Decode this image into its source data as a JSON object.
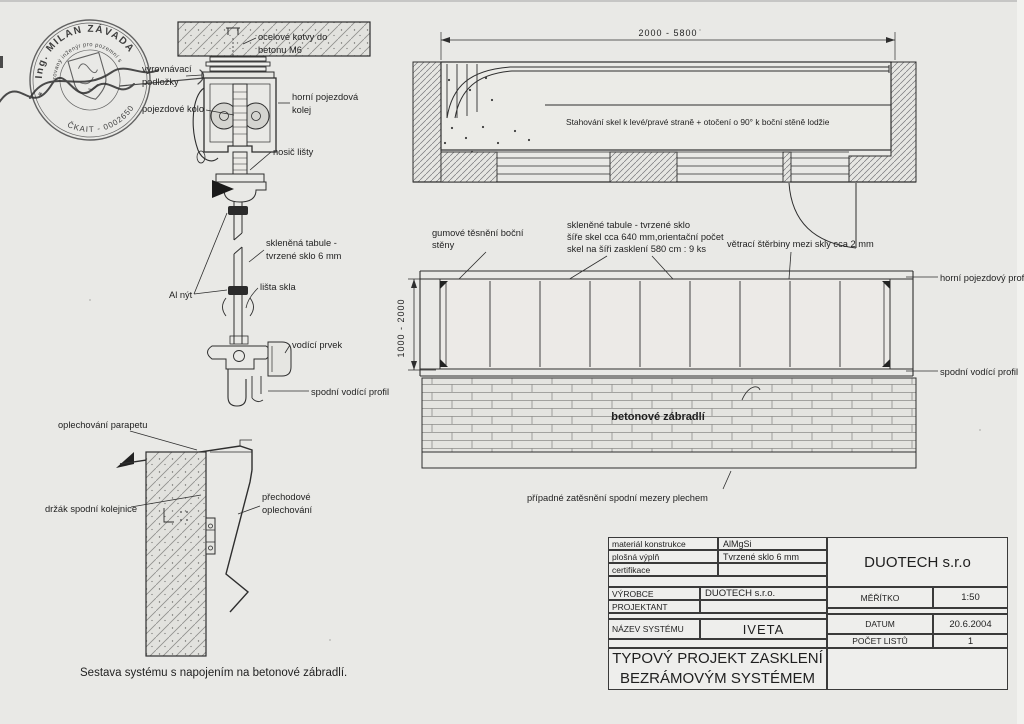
{
  "left_section": {
    "caption": "Sestava systému s napojením na betonové zábradlí.",
    "labels": {
      "anchor_l1": "ocelové kotvy do",
      "anchor_l2": "betonu M6",
      "shims_l1": "vyrovnávací",
      "shims_l2": "podložky",
      "wheel": "pojezdové kolo",
      "top_rail_l1": "horní pojezdová",
      "top_rail_l2": "kolej",
      "carrier": "nosič lišty",
      "glass_l1": "skleněná tabule -",
      "glass_l2": "tvrzené sklo 6 mm",
      "rivet": "Al nýt",
      "glass_strip": "lišta skla",
      "guide_element": "vodící prvek",
      "bottom_guide": "spodní vodící profil",
      "parapet_flashing": "oplechování parapetu",
      "rail_bracket": "držák spodní kolejnice",
      "transition_l1": "přechodové",
      "transition_l2": "oplechování"
    }
  },
  "plan_view": {
    "dimension": "2000 - 5800",
    "note": "Stahování skel k levé/pravé straně + otočení o 90° k boční stěně lodžie"
  },
  "elevation": {
    "dimension": "1000 - 2000",
    "panel_count": 9,
    "labels": {
      "gasket_l1": "gumové těsnění boční",
      "gasket_l2": "stěny",
      "glass_note_l1": "skleněné tabule  - tvrzené sklo",
      "glass_note_l2": "šíře skel cca 640 mm,orientační počet",
      "glass_note_l3": "skel na šíři zasklení 580 cm : 9 ks",
      "vent_note": "větrací štěrbiny mezi skly cca 2 mm",
      "top_profile": "horní pojezdový profil",
      "bottom_profile": "spodní vodící profil",
      "wall": "betonové zábradlí",
      "bottom_note": "případné zatěsnění spodní mezery plechem"
    }
  },
  "title_block": {
    "company": "DUOTECH s.r.o",
    "spec_rows": [
      {
        "label": "materiál konstrukce",
        "value": "AlMgSi"
      },
      {
        "label": "plošná výplň",
        "value": "Tvrzené sklo 6 mm"
      },
      {
        "label": "certifikace",
        "value": ""
      }
    ],
    "producer_label": "VÝROBCE",
    "producer_value": "DUOTECH s.r.o.",
    "designer_label": "PROJEKTANT",
    "designer_value": "",
    "system_label": "NÁZEV SYSTÉMU",
    "system_value": "IVETA",
    "scale_label": "MĚŘÍTKO",
    "scale_value": "1:50",
    "date_label": "DATUM",
    "date_value": "20.6.2004",
    "sheets_label": "POČET LISTŮ",
    "sheets_value": "1",
    "title_l1": "TYPOVÝ PROJEKT ZASKLENÍ",
    "title_l2": "BEZRÁMOVÝM SYSTÉMEM"
  },
  "stamp": {
    "name": "Ing. MILAN ZÁVADA",
    "role": "autorizovaný inženýr pro pozemní stavby",
    "number": "ČKAIT - 0002650"
  }
}
